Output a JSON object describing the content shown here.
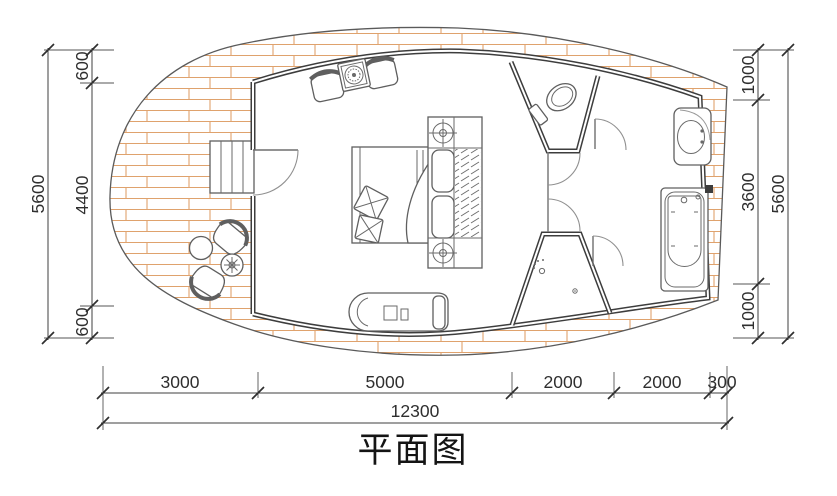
{
  "title": "平面图",
  "dims": {
    "left": {
      "overall": "5600",
      "segments": [
        "600",
        "4400",
        "600"
      ]
    },
    "right": {
      "overall": "5600",
      "segments": [
        "1000",
        "3600",
        "1000"
      ]
    },
    "bottom": {
      "overall": "12300",
      "segments": [
        "3000",
        "5000",
        "2000",
        "2000",
        "300"
      ]
    }
  },
  "colors": {
    "hatch_line": "#dfa26d",
    "wall": "#3d3d3d",
    "dim_line": "#3f3f3f"
  }
}
